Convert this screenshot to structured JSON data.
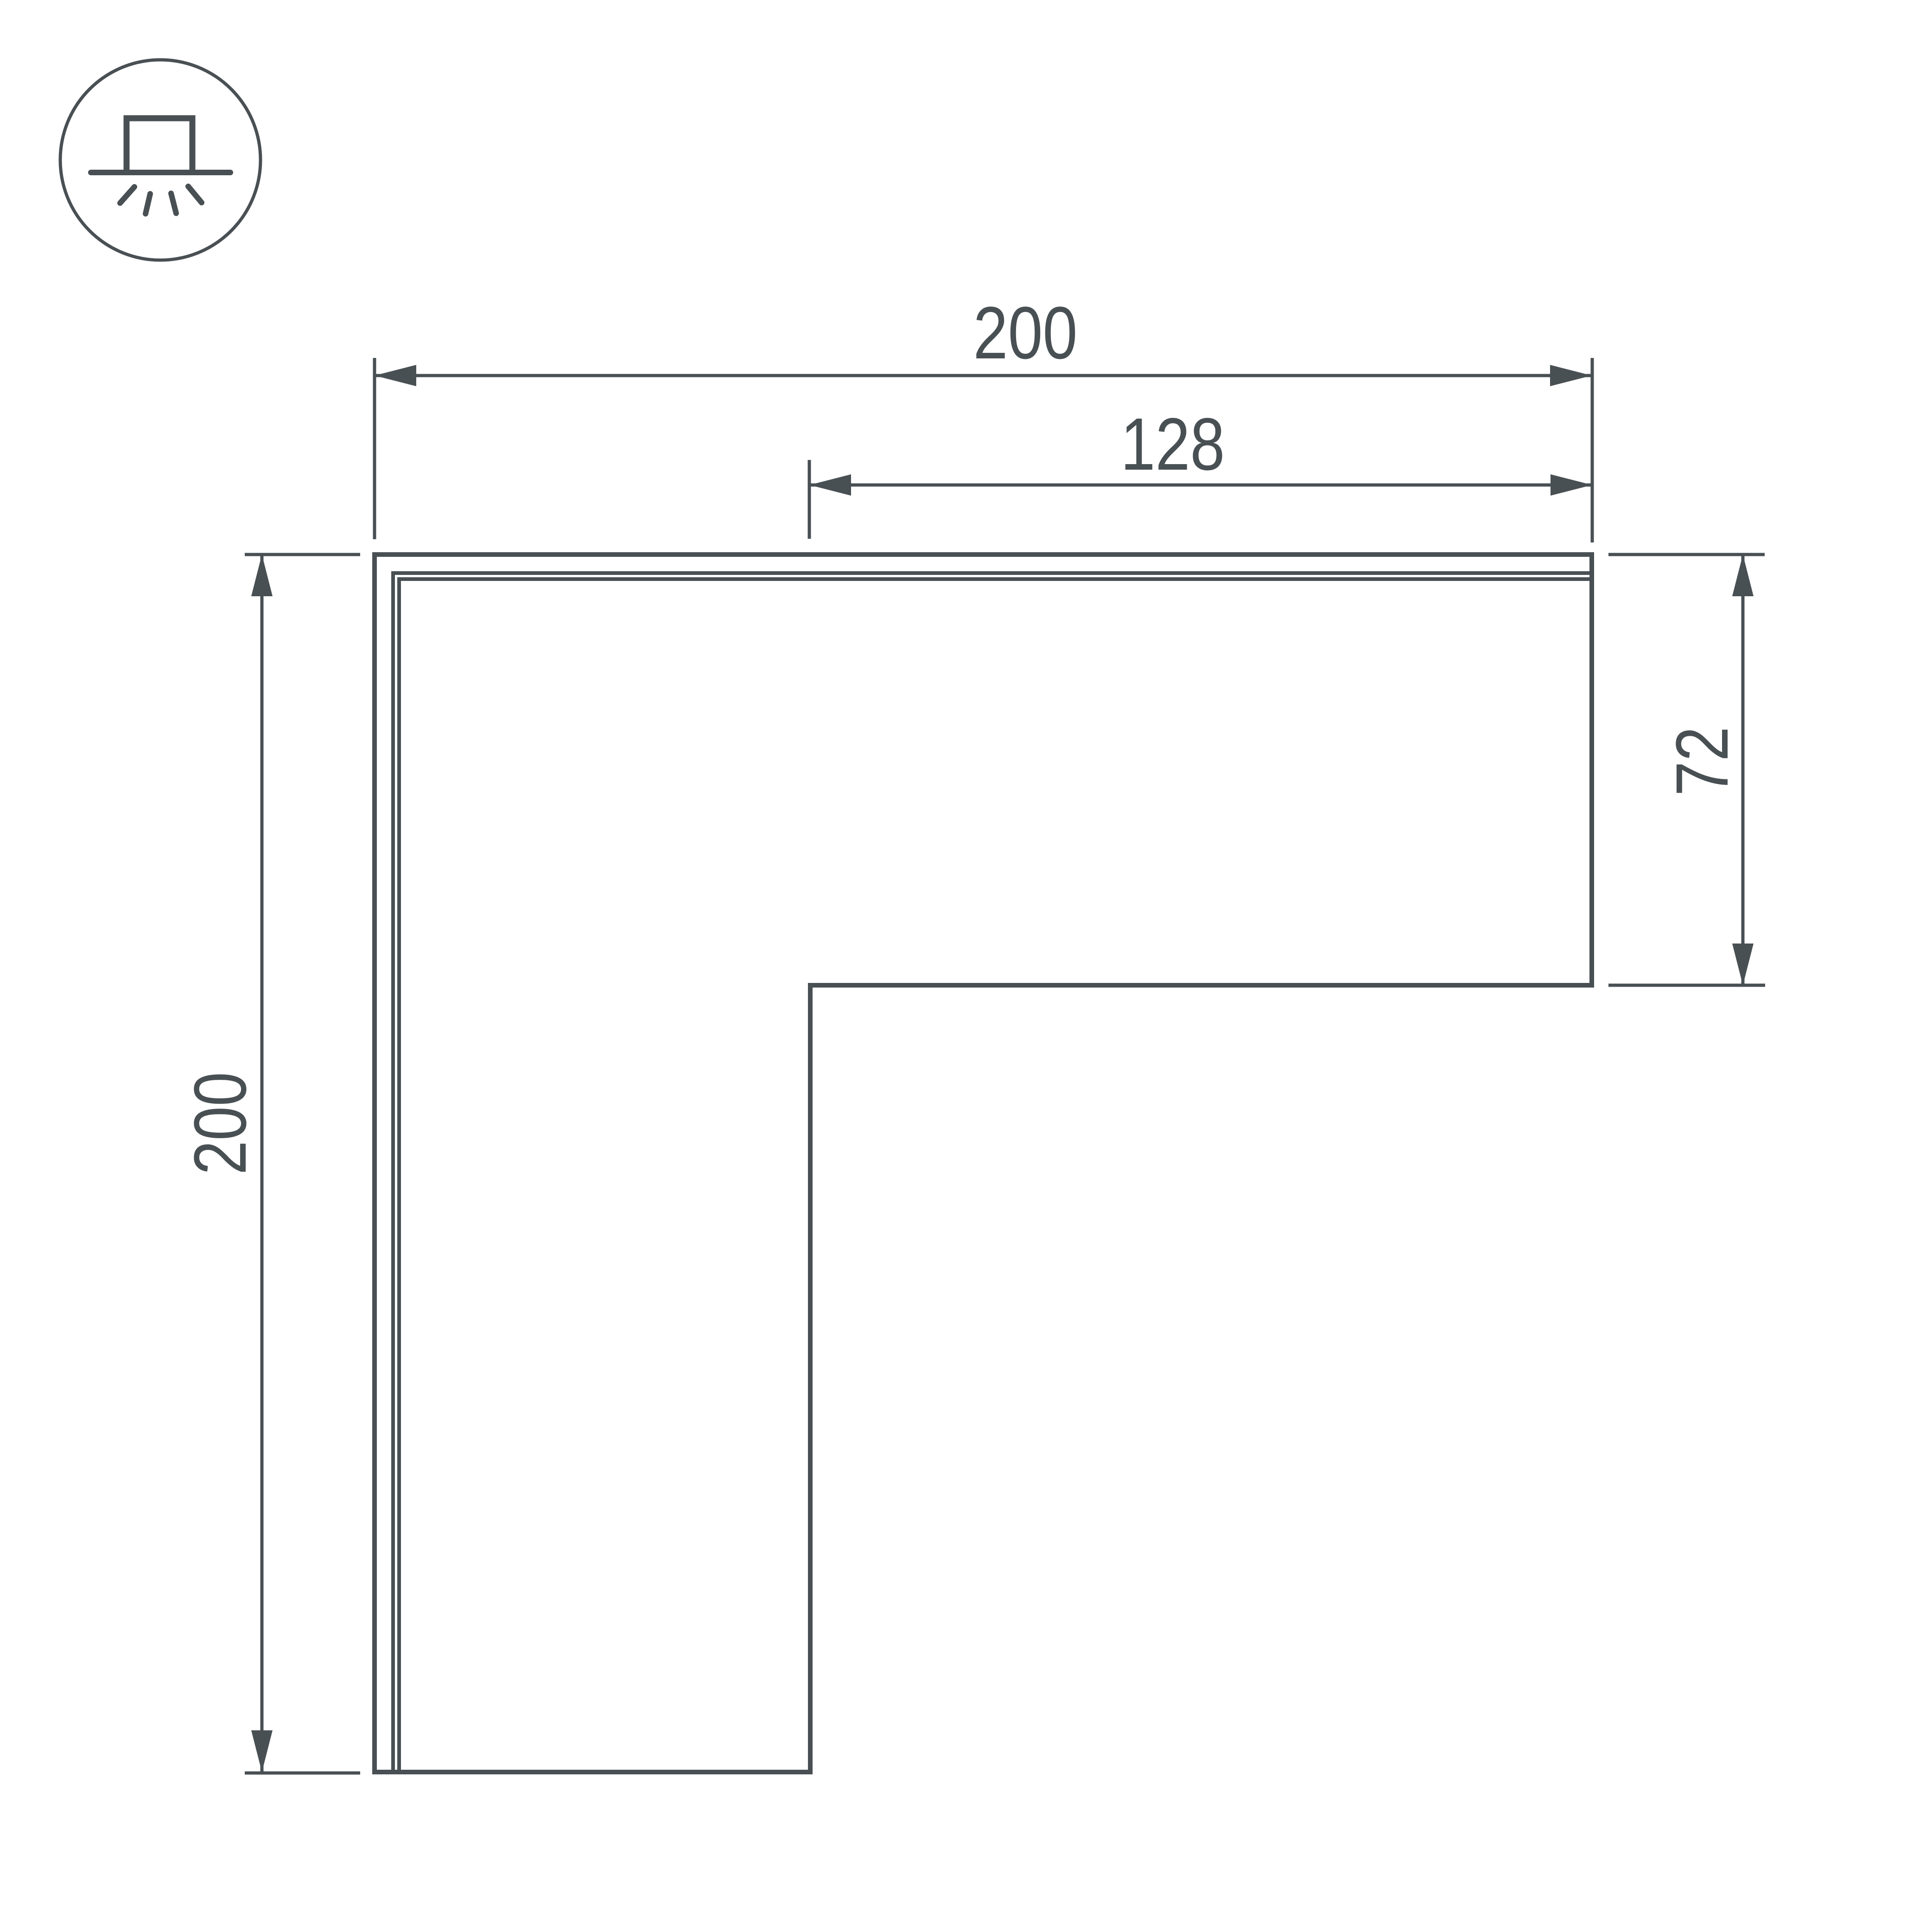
{
  "drawing": {
    "kind": "technical-dimension-drawing",
    "subject": "L-shaped corner connector profile, top view",
    "background_color": "#ffffff",
    "line_color": "#495054"
  },
  "icon": {
    "name": "surface-ceiling-light-icon",
    "description": "circled pictogram of a surface-mounted ceiling luminaire with light rays shining down"
  },
  "labels": {
    "top_width": "200",
    "inner_width": "128",
    "left_height": "200",
    "right_depth": "72"
  }
}
